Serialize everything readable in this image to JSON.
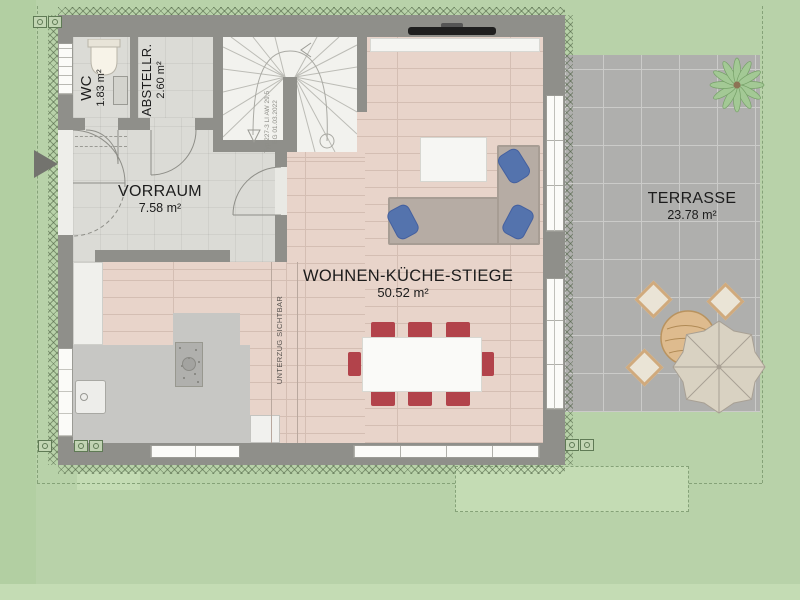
{
  "plan": {
    "rooms": [
      {
        "name": "WC",
        "area": "1.83 m²"
      },
      {
        "name": "ABSTELLR.",
        "area": "2.60 m²"
      },
      {
        "name": "VORRAUM",
        "area": "7.58 m²"
      },
      {
        "name": "WOHNEN-KÜCHE-STIEGE",
        "area": "50.52 m²"
      },
      {
        "name": "TERRASSE",
        "area": "23.78 m²"
      }
    ],
    "notes": {
      "beam": "UNTERZUG SICHTBAR",
      "stair_line1": "Typ 227-3 LI AW 29,5",
      "stair_line2": "EG 01.03.2022"
    }
  },
  "colors": {
    "lawn": "#b8d2a9",
    "lawnlight": "#c4dcb4",
    "lawnband": "#b2cfa2",
    "terrace": "#afafad",
    "terracegrid": "#cbcbc9",
    "wall": "#8f8f8a",
    "tilefloor": "#dbdbd6",
    "stairfloor": "#f2f2ee",
    "wood": "#e8d4ca",
    "woodline": "#d4beb3",
    "kitchen": "#c7c7c4",
    "sofa": "#b6aca4",
    "pillow": "#5473ad",
    "chairred": "#b2434b",
    "tablewood": "#debb8e",
    "parasol": "#d9d2c2",
    "plant": "#a3c995",
    "tv": "#1f1f1f",
    "text": "#1c1c1c",
    "arrow": "#73736e"
  }
}
